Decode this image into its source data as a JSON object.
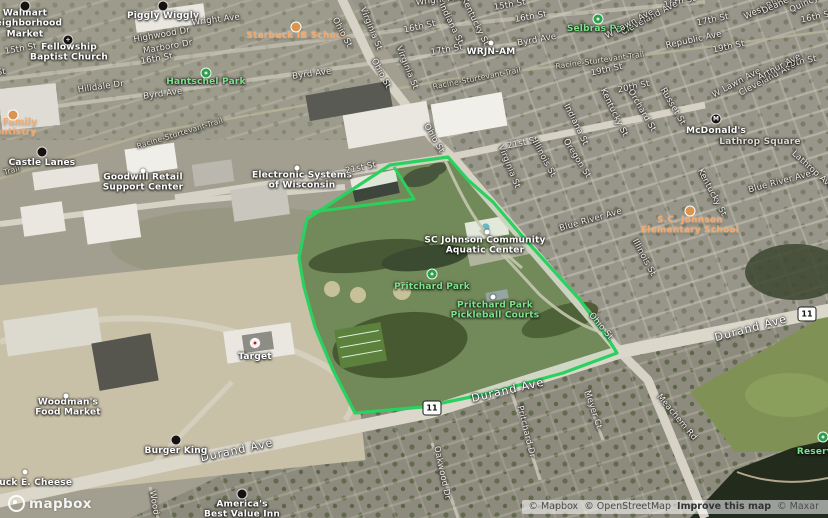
{
  "map": {
    "highlight_color": "#2ad15f",
    "boundary": {
      "points": "307,219 390,165 448,157 468,180 493,202 523,237 553,270 580,300 607,337 617,353 563,373 490,393 423,407 355,413 333,370 315,327 304,287 299,258 305,228",
      "notch": "394,167 414,199 312,212"
    },
    "shields": [
      {
        "id": "route-11-shield-west",
        "text": "11",
        "x": 432,
        "y": 408
      },
      {
        "id": "route-11-shield-east",
        "text": "11",
        "x": 807,
        "y": 314
      }
    ],
    "icons": [
      {
        "id": "walmart-icon",
        "kind": "icon-black",
        "x": 25,
        "y": 6
      },
      {
        "id": "piggly-wiggly-icon",
        "kind": "icon-black",
        "x": 163,
        "y": 6
      },
      {
        "id": "fellowship-church-icon",
        "kind": "icon-black",
        "glyph": "+",
        "x": 68,
        "y": 40
      },
      {
        "id": "starbuck-school-icon",
        "kind": "icon-orange",
        "x": 296,
        "y": 27
      },
      {
        "id": "hantschel-park-icon",
        "kind": "icon-green",
        "x": 206,
        "y": 73
      },
      {
        "id": "dentistry-icon",
        "kind": "icon-orange",
        "x": 13,
        "y": 115
      },
      {
        "id": "castle-lanes-icon",
        "kind": "icon-black",
        "x": 42,
        "y": 152
      },
      {
        "id": "goodwill-icon",
        "kind": "icon-dot",
        "x": 143,
        "y": 171
      },
      {
        "id": "electronic-systems-icon",
        "kind": "icon-dot",
        "x": 297,
        "y": 168
      },
      {
        "id": "wrjn-icon",
        "kind": "icon-dot",
        "x": 491,
        "y": 43
      },
      {
        "id": "selbras-park-icon",
        "kind": "icon-green",
        "x": 598,
        "y": 19
      },
      {
        "id": "mcdonalds-icon",
        "kind": "icon-black",
        "glyph": "M",
        "x": 716,
        "y": 119
      },
      {
        "id": "scj-elementary-icon",
        "kind": "icon-orange",
        "x": 690,
        "y": 211
      },
      {
        "id": "scj-aquatic-icon",
        "kind": "icon-dot",
        "x": 487,
        "y": 232
      },
      {
        "id": "pritchard-park-icon",
        "kind": "icon-green",
        "x": 432,
        "y": 274
      },
      {
        "id": "pickleball-icon",
        "kind": "icon-dot",
        "x": 493,
        "y": 297
      },
      {
        "id": "target-icon",
        "kind": "icon-target",
        "x": 255,
        "y": 343
      },
      {
        "id": "woodmans-icon",
        "kind": "icon-dot",
        "x": 66,
        "y": 396
      },
      {
        "id": "burger-king-icon",
        "kind": "icon-black",
        "x": 176,
        "y": 440
      },
      {
        "id": "chuck-e-cheese-icon",
        "kind": "icon-dot",
        "x": 25,
        "y": 472
      },
      {
        "id": "americas-inn-icon",
        "kind": "icon-black",
        "x": 242,
        "y": 494
      },
      {
        "id": "reservoir-icon",
        "kind": "icon-green",
        "x": 823,
        "y": 437
      }
    ],
    "labels": [
      {
        "id": "poi-walmart",
        "text": "Walmart\nNeighborhood\nMarket",
        "cls": "poi",
        "x": 25,
        "y": 24
      },
      {
        "id": "poi-piggly-wiggly",
        "text": "Piggly Wiggly",
        "cls": "poi",
        "x": 163,
        "y": 16
      },
      {
        "id": "street-wright-ave-1",
        "text": "Wright Ave",
        "cls": "",
        "x": 216,
        "y": 21,
        "rot": -7
      },
      {
        "id": "street-wright-ave-2",
        "text": "Wright Ave",
        "cls": "",
        "x": 440,
        "y": 1,
        "rot": -7
      },
      {
        "id": "poi-starbuck-school",
        "text": "Starbuck IB School",
        "cls": "poi orange",
        "x": 296,
        "y": 36
      },
      {
        "id": "street-highwood-dr",
        "text": "Highwood Dr",
        "cls": "",
        "x": 162,
        "y": 36,
        "rot": -10
      },
      {
        "id": "street-marboro-dr",
        "text": "Marboro Dr",
        "cls": "",
        "x": 168,
        "y": 48,
        "rot": -10
      },
      {
        "id": "street-16th-st-a",
        "text": "16th St",
        "cls": "",
        "x": 157,
        "y": 60,
        "rot": -10
      },
      {
        "id": "street-15th-st-left",
        "text": "15th St",
        "cls": "",
        "x": 21,
        "y": 50,
        "rot": -10
      },
      {
        "id": "street-16th-st-edge",
        "text": "16th St",
        "cls": "",
        "x": -10,
        "y": 75,
        "rot": -8
      },
      {
        "id": "poi-fellowship-church",
        "text": "Fellowship\nBaptist Church",
        "cls": "poi",
        "x": 69,
        "y": 53
      },
      {
        "id": "street-15th-st-mid",
        "text": "15th St",
        "cls": "",
        "x": 510,
        "y": 6,
        "rot": -10
      },
      {
        "id": "street-16th-st-b",
        "text": "16th St",
        "cls": "",
        "x": 420,
        "y": 28,
        "rot": -12
      },
      {
        "id": "street-16th-st-c",
        "text": "16th St",
        "cls": "",
        "x": 531,
        "y": 18,
        "rot": -10
      },
      {
        "id": "street-16th-st-d",
        "text": "16th St",
        "cls": "",
        "x": 680,
        "y": 3,
        "rot": -12
      },
      {
        "id": "street-16th-st-e",
        "text": "16th St",
        "cls": "",
        "x": 817,
        "y": 18,
        "rot": -12
      },
      {
        "id": "street-17th-st-a",
        "text": "17th St",
        "cls": "",
        "x": 447,
        "y": 51,
        "rot": -10
      },
      {
        "id": "street-17th-st-b",
        "text": "17th St",
        "cls": "",
        "x": 713,
        "y": 21,
        "rot": -12
      },
      {
        "id": "poi-wrjn",
        "text": "WRJN-AM",
        "cls": "poi",
        "x": 491,
        "y": 52
      },
      {
        "id": "street-byrd-ave-1",
        "text": "Byrd Ave",
        "cls": "",
        "x": 163,
        "y": 95,
        "rot": -8
      },
      {
        "id": "street-byrd-ave-2",
        "text": "Byrd Ave",
        "cls": "",
        "x": 312,
        "y": 75,
        "rot": -8
      },
      {
        "id": "street-byrd-ave-3",
        "text": "Byrd Ave",
        "cls": "",
        "x": 537,
        "y": 41,
        "rot": -10
      },
      {
        "id": "street-hilldale-dr",
        "text": "Hilldale Dr",
        "cls": "",
        "x": 101,
        "y": 88,
        "rot": -8
      },
      {
        "id": "poi-hantschel-park",
        "text": "Hantschel Park",
        "cls": "poi green",
        "x": 206,
        "y": 82
      },
      {
        "id": "street-indiana-st-1",
        "text": "Indiana St",
        "cls": "",
        "x": 450,
        "y": 24,
        "rot": 64
      },
      {
        "id": "street-kentucky-st-1",
        "text": "Kentucky St",
        "cls": "",
        "x": 474,
        "y": 22,
        "rot": 64
      },
      {
        "id": "street-virginia-st-1",
        "text": "Virginia St",
        "cls": "",
        "x": 370,
        "y": 29,
        "rot": 68
      },
      {
        "id": "street-virginia-st-2",
        "text": "Virginia St",
        "cls": "",
        "x": 406,
        "y": 68,
        "rot": 68
      },
      {
        "id": "street-ohio-st-1",
        "text": "Ohio St",
        "cls": "",
        "x": 341,
        "y": 33,
        "rot": 62
      },
      {
        "id": "street-ohio-st-2",
        "text": "Ohio St",
        "cls": "",
        "x": 380,
        "y": 74,
        "rot": 62
      },
      {
        "id": "street-ohio-st-3",
        "text": "Ohio St",
        "cls": "",
        "x": 433,
        "y": 139,
        "rot": 60
      },
      {
        "id": "trail-racine-1",
        "text": "Racine-Sturtevant-Trail",
        "cls": "trail",
        "x": 180,
        "y": 134,
        "rot": -17
      },
      {
        "id": "trail-racine-2",
        "text": "Racine-Sturtevant-Trail",
        "cls": "trail",
        "x": 477,
        "y": 79,
        "rot": -11
      },
      {
        "id": "trail-racine-3",
        "text": "Racine-Sturtevant-Trail",
        "cls": "trail",
        "x": 600,
        "y": 61,
        "rot": -8
      },
      {
        "id": "trail-left-fragment",
        "text": "Trail",
        "cls": "trail",
        "x": 12,
        "y": 171,
        "rot": -15
      },
      {
        "id": "poi-dentistry",
        "text": "ell Family\nDentistry",
        "cls": "poi orange",
        "x": 12,
        "y": 128
      },
      {
        "id": "poi-castle-lanes",
        "text": "Castle Lanes",
        "cls": "poi",
        "x": 42,
        "y": 163
      },
      {
        "id": "poi-goodwill",
        "text": "Goodwill Retail\nSupport Center",
        "cls": "poi",
        "x": 143,
        "y": 183
      },
      {
        "id": "poi-electronic-systems",
        "text": "Electronic Systems\nof Wisconsin",
        "cls": "poi",
        "x": 302,
        "y": 181
      },
      {
        "id": "street-21st-st-1",
        "text": "21st St",
        "cls": "",
        "x": 361,
        "y": 169,
        "rot": -12
      },
      {
        "id": "street-21st-st-2",
        "text": "21st St",
        "cls": "",
        "x": 523,
        "y": 144,
        "rot": -12
      },
      {
        "id": "poi-selbras-park",
        "text": "Selbras Park",
        "cls": "poi green",
        "x": 600,
        "y": 29
      },
      {
        "id": "street-cleveland-ave-1",
        "text": "Cleveland Ave",
        "cls": "",
        "x": 650,
        "y": 19,
        "rot": -28
      },
      {
        "id": "street-cleveland-ave-2",
        "text": "Cleveland Ave",
        "cls": "",
        "x": 768,
        "y": 80,
        "rot": -28
      },
      {
        "id": "street-wlawn-ave-1",
        "text": "W Lawn Ave",
        "cls": "",
        "x": 630,
        "y": 25,
        "rot": -28
      },
      {
        "id": "street-wlawn-ave-2",
        "text": "W Lawn Ave",
        "cls": "",
        "x": 737,
        "y": 84,
        "rot": -28
      },
      {
        "id": "street-west-blvd",
        "text": "West Blvd",
        "cls": "",
        "x": 765,
        "y": 9,
        "rot": -25
      },
      {
        "id": "street-deane-blvd",
        "text": "Deane Blvd",
        "cls": "",
        "x": 786,
        "y": 2,
        "rot": -25
      },
      {
        "id": "street-quincy-ave",
        "text": "Quincy Ave",
        "cls": "",
        "x": 813,
        "y": 1,
        "rot": -25
      },
      {
        "id": "street-republic-ave",
        "text": "Republic Ave",
        "cls": "",
        "x": 694,
        "y": 41,
        "rot": -12
      },
      {
        "id": "street-19th-st-a",
        "text": "19th St",
        "cls": "",
        "x": 729,
        "y": 48,
        "rot": -12
      },
      {
        "id": "street-19th-st-b",
        "text": "19th St",
        "cls": "",
        "x": 607,
        "y": 71,
        "rot": -12
      },
      {
        "id": "street-20th-st-a",
        "text": "20th St",
        "cls": "",
        "x": 801,
        "y": 63,
        "rot": -12
      },
      {
        "id": "street-20th-st-b",
        "text": "20th St",
        "cls": "",
        "x": 634,
        "y": 88,
        "rot": -12
      },
      {
        "id": "street-arthur-ave",
        "text": "Arthur Ave",
        "cls": "",
        "x": 780,
        "y": 68,
        "rot": -28
      },
      {
        "id": "street-kentucky-st-2",
        "text": "Kentucky St",
        "cls": "",
        "x": 613,
        "y": 113,
        "rot": 64
      },
      {
        "id": "street-indiana-st-2",
        "text": "Indiana St",
        "cls": "",
        "x": 575,
        "y": 125,
        "rot": 64
      },
      {
        "id": "street-orchard-st",
        "text": "Orchard St",
        "cls": "",
        "x": 641,
        "y": 111,
        "rot": 60
      },
      {
        "id": "street-russet-st",
        "text": "Russet St",
        "cls": "",
        "x": 672,
        "y": 107,
        "rot": 60
      },
      {
        "id": "poi-mcdonalds",
        "text": "McDonald's",
        "cls": "poi",
        "x": 716,
        "y": 131
      },
      {
        "id": "poi-lathrop-square",
        "text": "Lathrop Square",
        "cls": "poi gray",
        "x": 760,
        "y": 142
      },
      {
        "id": "street-oregon-st",
        "text": "Oregon St",
        "cls": "",
        "x": 576,
        "y": 159,
        "rot": 58
      },
      {
        "id": "street-illinois-st-1",
        "text": "Illinois St",
        "cls": "",
        "x": 543,
        "y": 159,
        "rot": 62
      },
      {
        "id": "street-illinois-st-2",
        "text": "Illinois St",
        "cls": "",
        "x": 643,
        "y": 258,
        "rot": 62
      },
      {
        "id": "street-virginia-st-3",
        "text": "Virginia St",
        "cls": "",
        "x": 508,
        "y": 167,
        "rot": 68
      },
      {
        "id": "street-kentucky-st-3",
        "text": "Kentucky St",
        "cls": "",
        "x": 711,
        "y": 193,
        "rot": 62
      },
      {
        "id": "street-lathrop-ave",
        "text": "Lathrop Ave",
        "cls": "",
        "x": 812,
        "y": 171,
        "rot": 42
      },
      {
        "id": "street-blue-river-1",
        "text": "Blue River Ave",
        "cls": "",
        "x": 591,
        "y": 221,
        "rot": -16
      },
      {
        "id": "street-blue-river-2",
        "text": "Blue River Ave",
        "cls": "",
        "x": 780,
        "y": 183,
        "rot": -15
      },
      {
        "id": "poi-scj-elementary",
        "text": "S.C. Johnson\nElementary School",
        "cls": "poi orange",
        "x": 690,
        "y": 226
      },
      {
        "id": "poi-scj-aquatic",
        "text": "SC Johnson Community\nAquatic Center",
        "cls": "poi",
        "x": 485,
        "y": 246
      },
      {
        "id": "poi-pritchard-park",
        "text": "Pritchard Park",
        "cls": "poi green",
        "x": 432,
        "y": 287
      },
      {
        "id": "poi-pickleball-courts",
        "text": "Pritchard Park\nPickleball Courts",
        "cls": "poi green",
        "x": 495,
        "y": 311
      },
      {
        "id": "street-ohio-st-4",
        "text": "Ohio St",
        "cls": "",
        "x": 600,
        "y": 327,
        "rot": 50
      },
      {
        "id": "street-durand-ave-1",
        "text": "Durand Ave",
        "cls": "street-big",
        "x": 508,
        "y": 391,
        "rot": -13
      },
      {
        "id": "street-durand-ave-2",
        "text": "Durand Ave",
        "cls": "street-big",
        "x": 751,
        "y": 329,
        "rot": -15
      },
      {
        "id": "street-durand-ave-3",
        "text": "Durand Ave",
        "cls": "street-big",
        "x": 237,
        "y": 451,
        "rot": -12
      },
      {
        "id": "street-meyer-ct",
        "text": "Meyer Ct",
        "cls": "",
        "x": 592,
        "y": 410,
        "rot": 72
      },
      {
        "id": "street-meachem-rd",
        "text": "Meachem Rd",
        "cls": "",
        "x": 676,
        "y": 418,
        "rot": 50
      },
      {
        "id": "street-pritchard-dr",
        "text": "Pritchard Dr",
        "cls": "",
        "x": 525,
        "y": 432,
        "rot": 76
      },
      {
        "id": "street-oakwood-dr",
        "text": "Oakwood Dr",
        "cls": "",
        "x": 441,
        "y": 473,
        "rot": 78
      },
      {
        "id": "street-wood-fragment",
        "text": "Wood",
        "cls": "",
        "x": 153,
        "y": 503,
        "rot": 80
      },
      {
        "id": "poi-burger-king",
        "text": "Burger King",
        "cls": "poi",
        "x": 176,
        "y": 451
      },
      {
        "id": "poi-chuck-e-cheese",
        "text": "Chuck E. Cheese",
        "cls": "poi",
        "x": 29,
        "y": 483
      },
      {
        "id": "poi-woodmans",
        "text": "Woodman's\nFood Market",
        "cls": "poi",
        "x": 68,
        "y": 408
      },
      {
        "id": "poi-target",
        "text": "Target",
        "cls": "poi",
        "x": 255,
        "y": 357
      },
      {
        "id": "poi-americas-inn",
        "text": "America's\nBest Value Inn",
        "cls": "poi",
        "x": 242,
        "y": 510
      },
      {
        "id": "poi-reservoir",
        "text": "Reservoir",
        "cls": "poi green",
        "x": 822,
        "y": 452
      }
    ]
  },
  "branding": {
    "logo_text": "mapbox"
  },
  "attribution": {
    "mapbox": "© Mapbox",
    "osm": "© OpenStreetMap",
    "improve": "Improve this map",
    "maxar": "© Maxar"
  }
}
